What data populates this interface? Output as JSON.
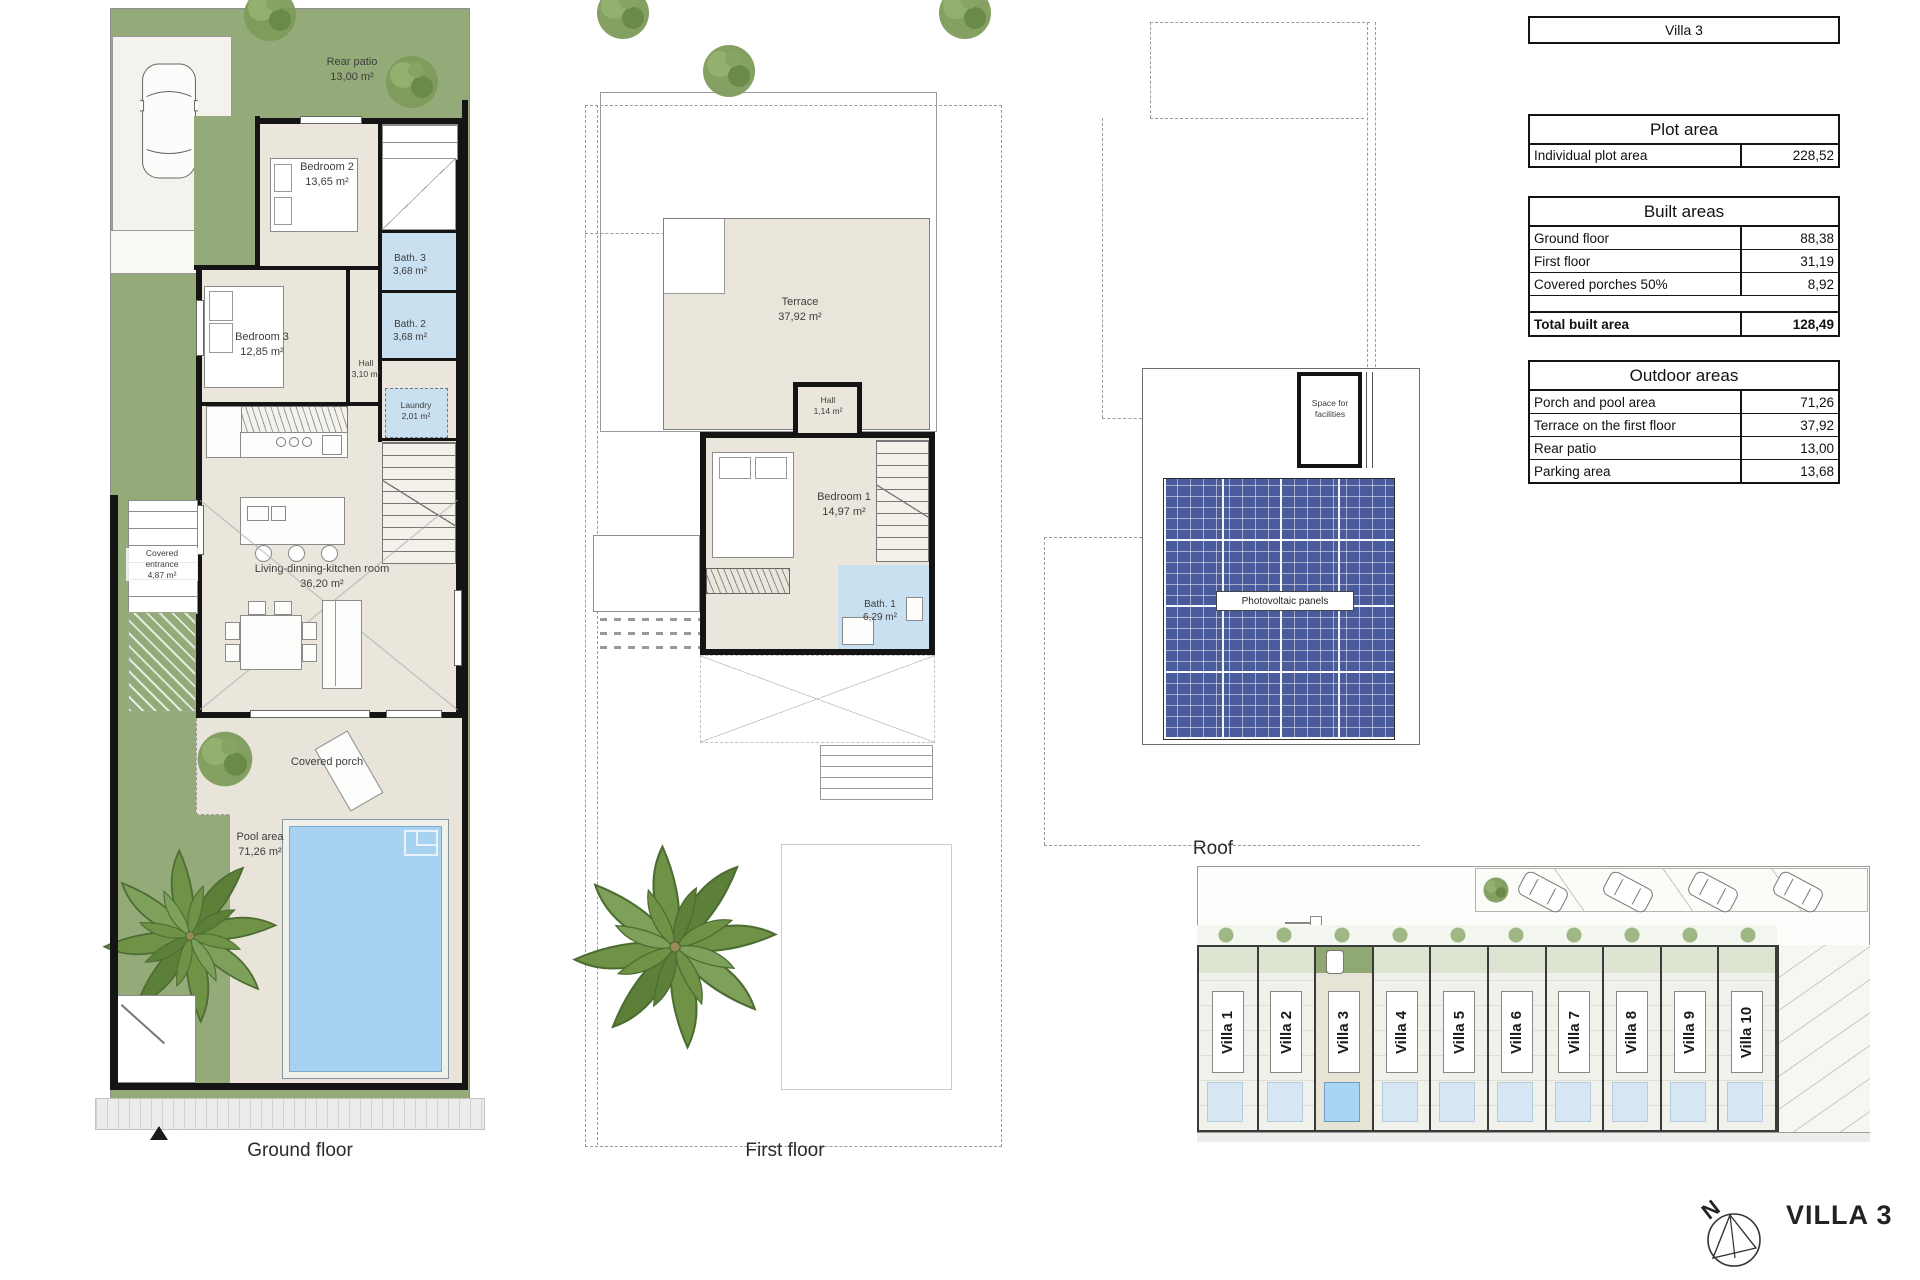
{
  "ground_floor": {
    "caption": "Ground floor",
    "labels": {
      "rear_patio_name": "Rear patio",
      "rear_patio_area": "13,00 m²",
      "bedroom2_name": "Bedroom 2",
      "bedroom2_area": "13,65 m²",
      "bath3_name": "Bath. 3",
      "bath3_area": "3,68 m²",
      "bath2_name": "Bath. 2",
      "bath2_area": "3,68 m²",
      "bedroom3_name": "Bedroom 3",
      "bedroom3_area": "12,85 m²",
      "hall_name": "Hall",
      "hall_area": "3,10 m²",
      "laundry_name": "Laundry",
      "laundry_area": "2,01 m²",
      "living_name": "Living-dinning-kitchen room",
      "living_area": "36,20 m²",
      "covered_entrance_line1": "Covered",
      "covered_entrance_line2": "entrance",
      "covered_entrance_area": "4,87 m²",
      "covered_porch": "Covered porch",
      "pool_name": "Pool area",
      "pool_area": "71,26 m²"
    }
  },
  "first_floor": {
    "caption": "First floor",
    "labels": {
      "terrace_name": "Terrace",
      "terrace_area": "37,92 m²",
      "hall_name": "Hall",
      "hall_area": "1,14 m²",
      "bedroom1_name": "Bedroom 1",
      "bedroom1_area": "14,97 m²",
      "bath1_name": "Bath. 1",
      "bath1_area": "6,29 m²"
    }
  },
  "roof": {
    "caption": "Roof",
    "labels": {
      "space_line1": "Space for",
      "space_line2": "facilities",
      "pv": "Photovoltaic panels"
    }
  },
  "site_plan": {
    "villas": [
      {
        "label": "Villa 1"
      },
      {
        "label": "Villa 2"
      },
      {
        "label": "Villa 3"
      },
      {
        "label": "Villa 4"
      },
      {
        "label": "Villa 5"
      },
      {
        "label": "Villa 6"
      },
      {
        "label": "Villa 7"
      },
      {
        "label": "Villa 8"
      },
      {
        "label": "Villa 9"
      },
      {
        "label": "Villa 10"
      }
    ]
  },
  "info_tables": {
    "villa_title": "Villa 3",
    "plot": {
      "title": "Plot area",
      "rows": [
        {
          "label": "Individual plot area",
          "value": "228,52"
        }
      ]
    },
    "built": {
      "title": "Built areas",
      "rows": [
        {
          "label": "Ground floor",
          "value": "88,38"
        },
        {
          "label": "First floor",
          "value": "31,19"
        },
        {
          "label": "Covered porches 50%",
          "value": "8,92"
        }
      ],
      "total_label": "Total built area",
      "total_value": "128,49"
    },
    "outdoor": {
      "title": "Outdoor areas",
      "rows": [
        {
          "label": "Porch and pool area",
          "value": "71,26"
        },
        {
          "label": "Terrace on the first floor",
          "value": "37,92"
        },
        {
          "label": "Rear patio",
          "value": "13,00"
        },
        {
          "label": "Parking area",
          "value": "13,68"
        }
      ]
    }
  },
  "compass": {
    "north": "N",
    "villa_label": "VILLA 3"
  }
}
